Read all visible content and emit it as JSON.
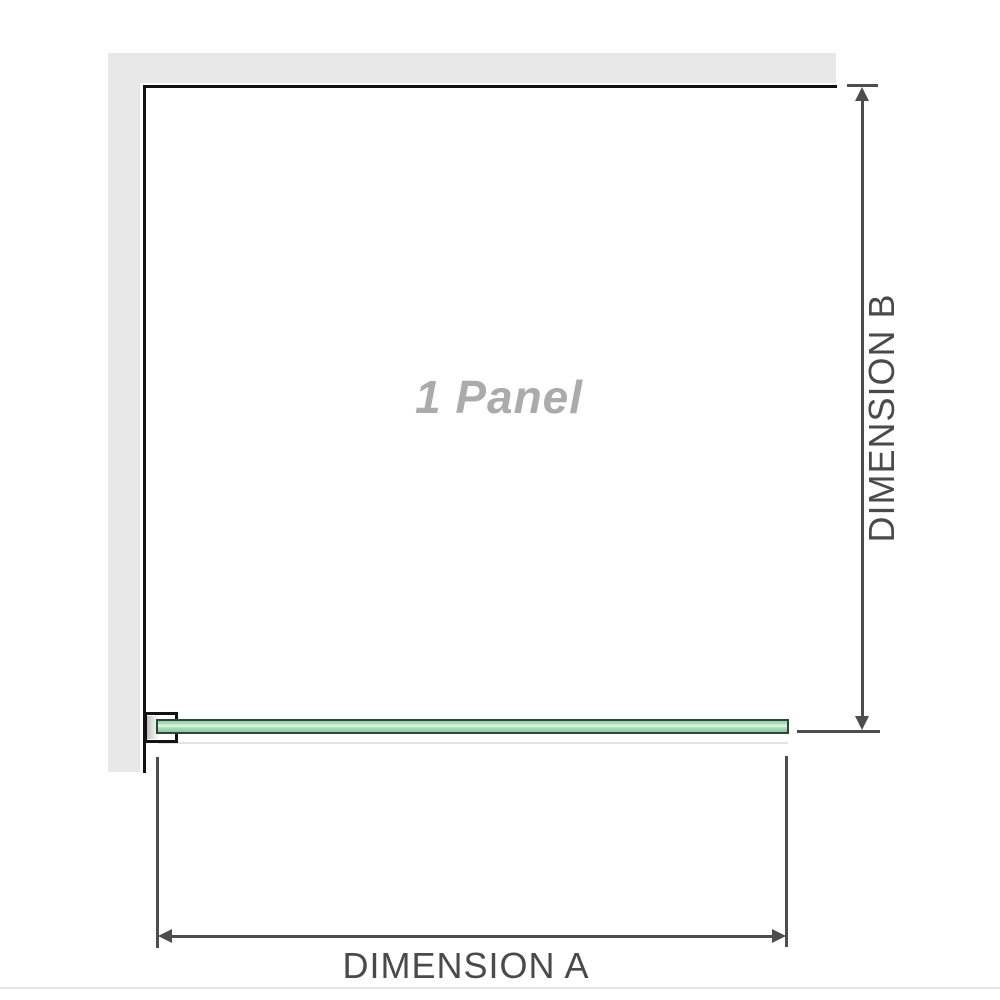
{
  "diagram": {
    "panel_label": "1 Panel",
    "dimension_a_label": "DIMENSION A",
    "dimension_b_label": "DIMENSION B"
  },
  "colors": {
    "wall": "#e8e8e8",
    "panel_border": "#121212",
    "dimension": "#4d4d4d",
    "label_text": "#4a4a4a",
    "panel_text": "#ababab",
    "glass_border": "#2b4936",
    "glass_highlight": "#ebf8ef",
    "bracket_fill": "#ffffff",
    "baseline": "#e7e5e0"
  }
}
